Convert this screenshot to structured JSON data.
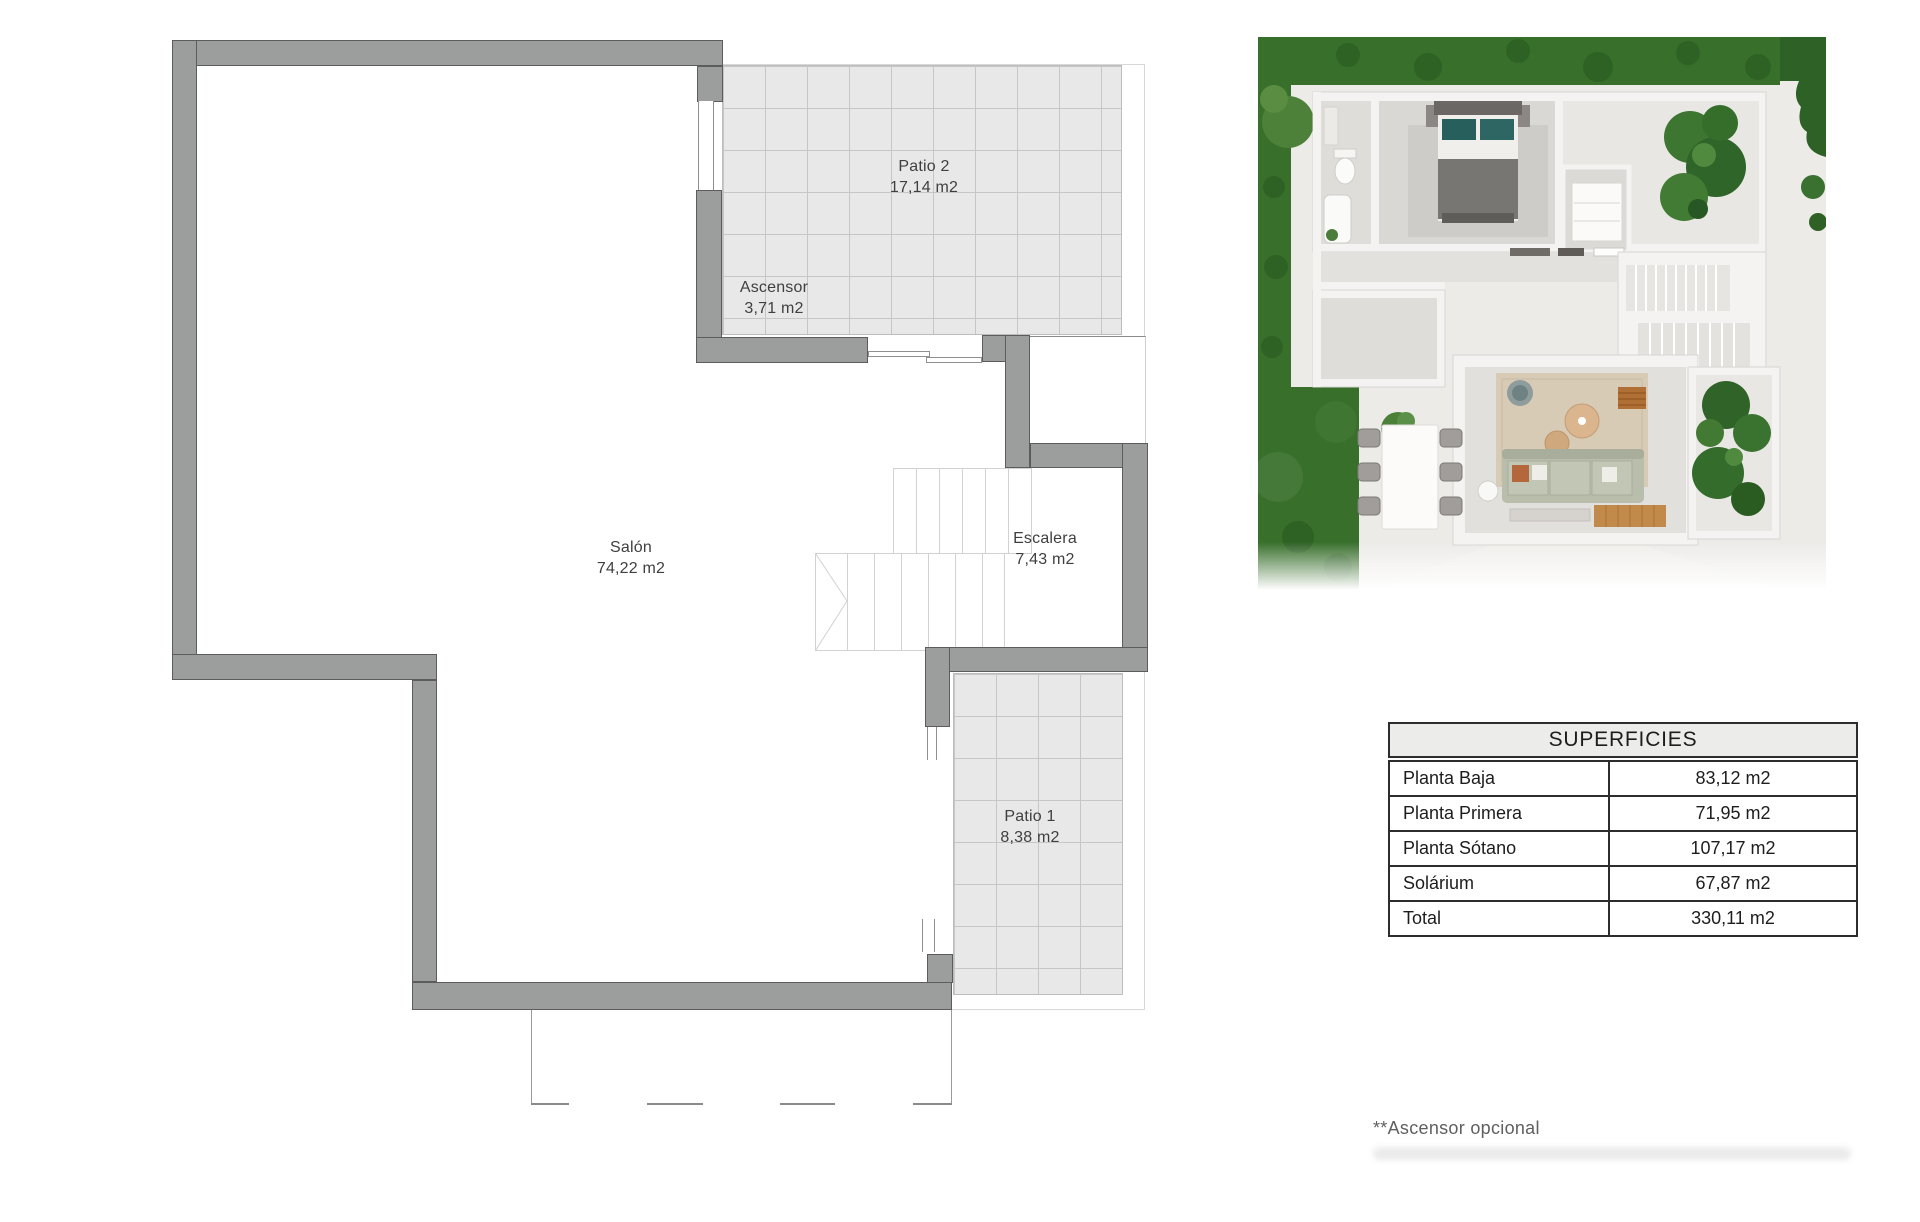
{
  "floor_plan": {
    "rooms": [
      {
        "id": "patio2",
        "name": "Patio 2",
        "area": "17,14 m2"
      },
      {
        "id": "ascensor",
        "name": "Ascensor",
        "area": "3,71 m2"
      },
      {
        "id": "salon",
        "name": "Salón",
        "area": "74,22 m2"
      },
      {
        "id": "escalera",
        "name": "Escalera",
        "area": "7,43 m2"
      },
      {
        "id": "patio1",
        "name": "Patio 1",
        "area": "8,38 m2"
      }
    ]
  },
  "surfaces_table": {
    "title": "SUPERFICIES",
    "rows": [
      {
        "label": "Planta Baja",
        "value": "83,12 m2"
      },
      {
        "label": "Planta Primera",
        "value": "71,95 m2"
      },
      {
        "label": "Planta Sótano",
        "value": "107,17 m2"
      },
      {
        "label": "Solárium",
        "value": "67,87 m2"
      },
      {
        "label": "Total",
        "value": "330,11 m2"
      }
    ]
  },
  "footnote": "**Ascensor opcional",
  "colors": {
    "wall": "#9c9e9d",
    "patio_grid": "#e8e8e8",
    "grass": "#386f2b",
    "table_border": "#2d2d2d"
  }
}
